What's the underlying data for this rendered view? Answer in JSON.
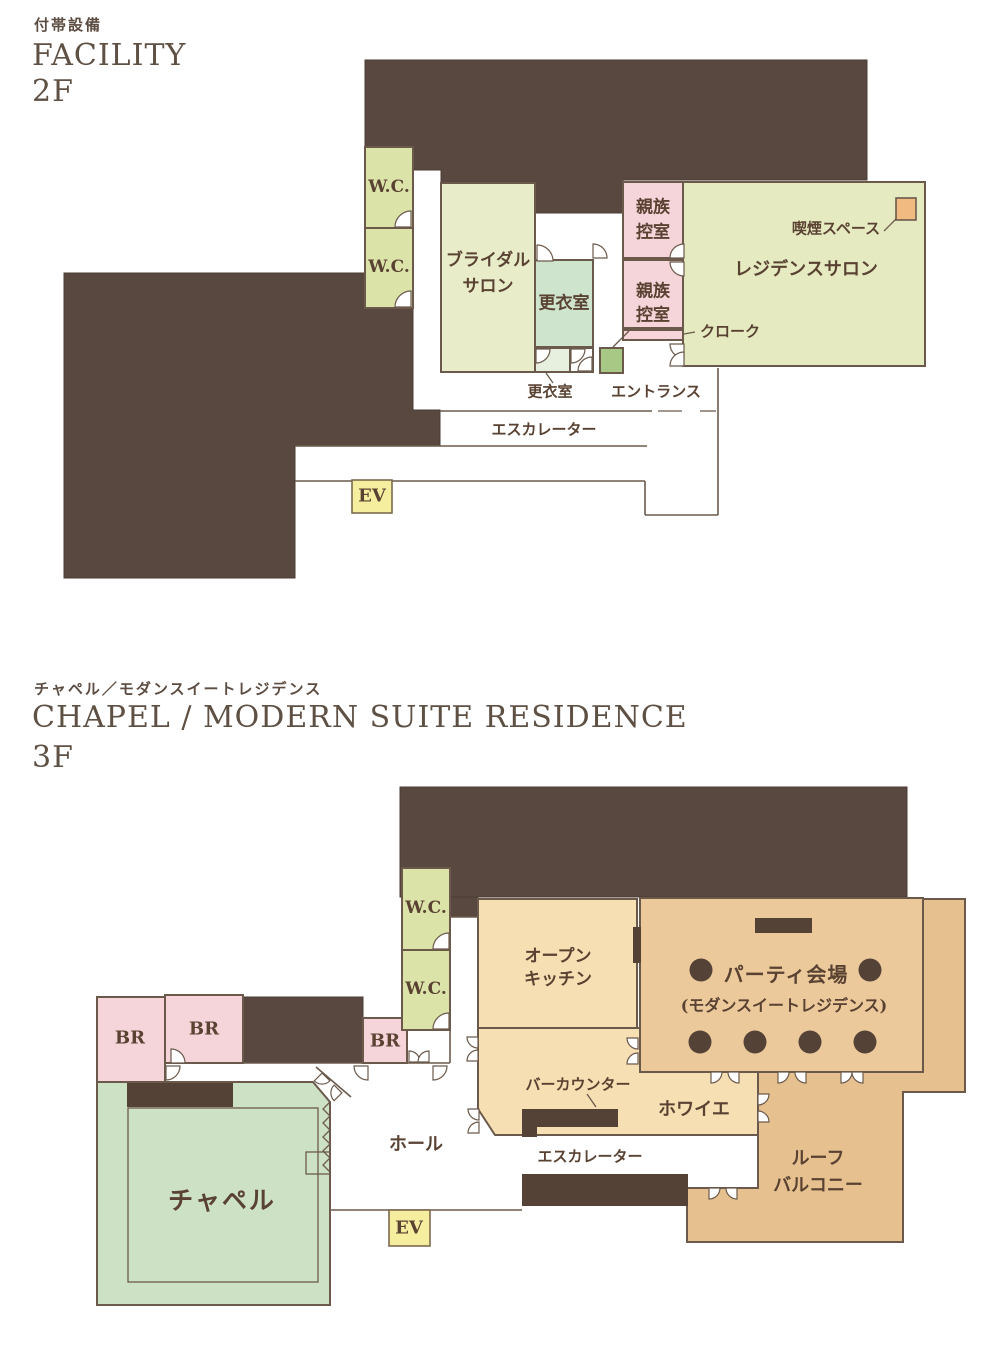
{
  "palette": {
    "building_mass_brown": "#594840",
    "outline_brown": "#6b5a4c",
    "label_text_brown": "#5a4233",
    "header_text_brown": "#5f5044",
    "wc_green": "#dce3a9",
    "bridal_salon_green": "#e9ecc9",
    "residence_salon_green": "#e5eac0",
    "changing_room_mint": "#cfe4cd",
    "changing_room_mint_light": "#e7f0de",
    "entrance_green": "#a8c985",
    "waiting_room_pink": "#f5d5d9",
    "kitchen_foyer_tan": "#f6dfb2",
    "party_room_tan": "#ebc99b",
    "roof_balcony_tan": "#e7c08f",
    "chapel_green": "#cde1c5",
    "elevator_yellow": "#f5ee9e",
    "smoking_orange": "#f0ba80",
    "furniture_dark": "#554237"
  },
  "f2": {
    "kicker": "付帯設備",
    "title": "FACILITY",
    "floor": "2F",
    "labels": {
      "wc1": "W.C.",
      "wc2": "W.C.",
      "bridal": [
        "ブライダル",
        "サロン"
      ],
      "changing": "更衣室",
      "family1": [
        "親族",
        "控室"
      ],
      "family2": [
        "親族",
        "控室"
      ],
      "residence": "レジデンスサロン",
      "smoking": "喫煙スペース",
      "cloak": "クローク",
      "changing_small": "更衣室",
      "entrance": "エントランス",
      "escalator": "エスカレーター",
      "ev": "EV"
    }
  },
  "f3": {
    "kicker": "チャペル／モダンスイートレジデンス",
    "title": "CHAPEL / MODERN SUITE RESIDENCE",
    "floor": "3F",
    "labels": {
      "wc1": "W.C.",
      "wc2": "W.C.",
      "br1": "BR",
      "br2": "BR",
      "br3": "BR",
      "kitchen": [
        "オープン",
        "キッチン"
      ],
      "party": "パーティ会場",
      "party_sub": "(モダンスイートレジデンス)",
      "bar": "バーカウンター",
      "foyer": "ホワイエ",
      "escalator": "エスカレーター",
      "roof": [
        "ルーフ",
        "バルコニー"
      ],
      "hall": "ホール",
      "chapel": "チャペル",
      "ev": "EV"
    }
  }
}
